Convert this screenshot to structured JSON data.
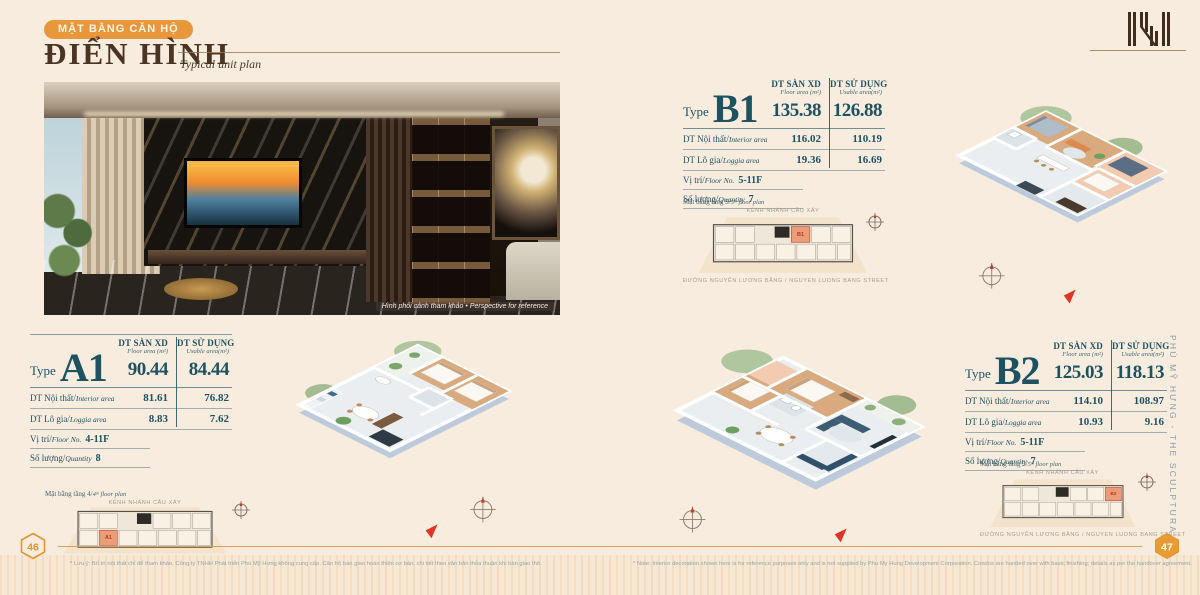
{
  "header": {
    "badge": "MẶT BẰNG CĂN HỘ",
    "title": "ĐIỂN HÌNH",
    "subtitle": "Typical unit plan"
  },
  "brand": {
    "vertical_text": "PHÚ MỸ HƯNG  -  THE SCULPTURA",
    "logo": "sculptura-monogram"
  },
  "photo": {
    "caption": "Hình phối cảnh tham khảo • Perspective for reference"
  },
  "labels": {
    "type": "Type",
    "floor_area_vi": "DT SÀN XD",
    "floor_area_en": "Floor area (m²)",
    "usable_vi": "DT SỬ DỤNG",
    "usable_en": "Usable area(m²)",
    "interior_vi": "DT Nội thất/",
    "interior_en": "Interior area",
    "loggia_vi": "DT Lô gia/",
    "loggia_en": "Loggia area",
    "position_vi": "Vị trí/",
    "position_en": "Floor No.",
    "quantity_vi": "Số lượng/",
    "quantity_en": "Quantity"
  },
  "units": [
    {
      "code": "A1",
      "floor_area": "90.44",
      "usable_area": "84.44",
      "interior": "81.61",
      "interior_usable": "76.82",
      "loggia": "8.83",
      "loggia_usable": "7.62",
      "floors": "4-11F",
      "quantity": "8",
      "keyplan_prefix": "Mặt bằng tầng 4/",
      "keyplan_suffix": "4ᵗʰ floor plan"
    },
    {
      "code": "B1",
      "floor_area": "135.38",
      "usable_area": "126.88",
      "interior": "116.02",
      "interior_usable": "110.19",
      "loggia": "19.36",
      "loggia_usable": "16.69",
      "floors": "5-11F",
      "quantity": "7",
      "keyplan_prefix": "Mặt bằng tầng 5/",
      "keyplan_suffix": "5ᵗʰ floor plan"
    },
    {
      "code": "B2",
      "floor_area": "125.03",
      "usable_area": "118.13",
      "interior": "114.10",
      "interior_usable": "108.97",
      "loggia": "10.93",
      "loggia_usable": "9.16",
      "floors": "5-11F",
      "quantity": "7",
      "keyplan_prefix": "Mặt bằng tầng 5/",
      "keyplan_suffix": "5ᵗʰ floor plan"
    }
  ],
  "keyplan": {
    "road_top": "KÊNH NHÁNH CẦU XÂY",
    "road_bottom": "ĐƯỜNG NGUYỄN LƯƠNG BẰNG / NGUYEN LUONG BANG STREET"
  },
  "pagination": {
    "left": "46",
    "right": "47"
  },
  "footnotes": {
    "left": "* Lưu ý: Bố trí nội thất chỉ để tham khảo, Công ty TNHH Phát triển Phú Mỹ Hưng không cung cấp. Căn hộ bàn giao hoàn thiện cơ bản, chi tiết theo văn bản thỏa thuận khi bàn giao thô.",
    "right": "* Note: Interior decoration shown here is for reference purposes only and is not supplied by Phu My Hung Development Corporation. Condos are handed over with basic finishing; details as per the handover agreement."
  },
  "colors": {
    "accent_orange": "#E8973B",
    "panel_teal": "#1D5261",
    "title_brown": "#4A3424",
    "background": "#F8ECDF"
  }
}
